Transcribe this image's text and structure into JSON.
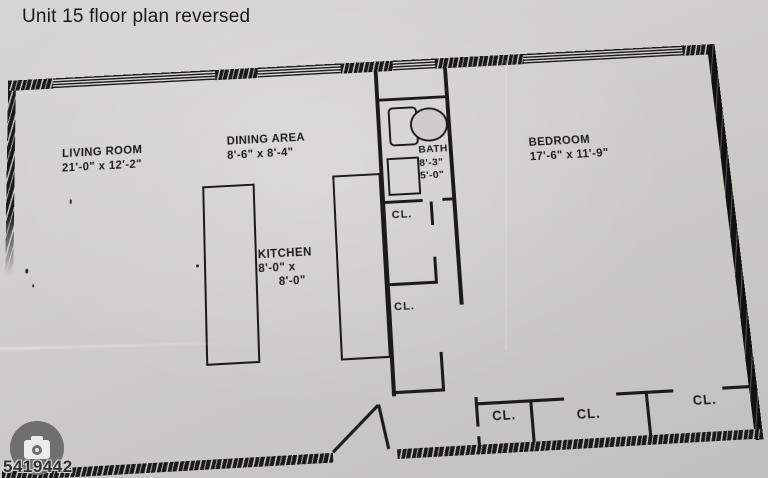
{
  "title": "Unit 15 floor plan reversed",
  "rooms": [
    {
      "name": "LIVING ROOM",
      "dims": "21'-0\" x 12'-2\""
    },
    {
      "name": "DINING AREA",
      "dims": "8'-6\" x 8'-4\""
    },
    {
      "name": "KITCHEN",
      "dims_line1": "8'-0\" x",
      "dims_line2": "8'-0\""
    },
    {
      "name": "BATH",
      "dims_line1": "8'-3\"",
      "dims_line2": "5'-0\""
    },
    {
      "name": "BEDROOM",
      "dims": "17'-6\" x 11'-9\""
    }
  ],
  "closets": {
    "upper": "CL.",
    "lower": "CL.",
    "bedroom": [
      "CL.",
      "CL.",
      "CL."
    ]
  },
  "watermark": {
    "text": "5419442",
    "icon": "camera-icon"
  },
  "colors": {
    "paper": "#cecdc9",
    "ink": "#1b1b1b",
    "watermark_circle": "#6f6f6f"
  }
}
